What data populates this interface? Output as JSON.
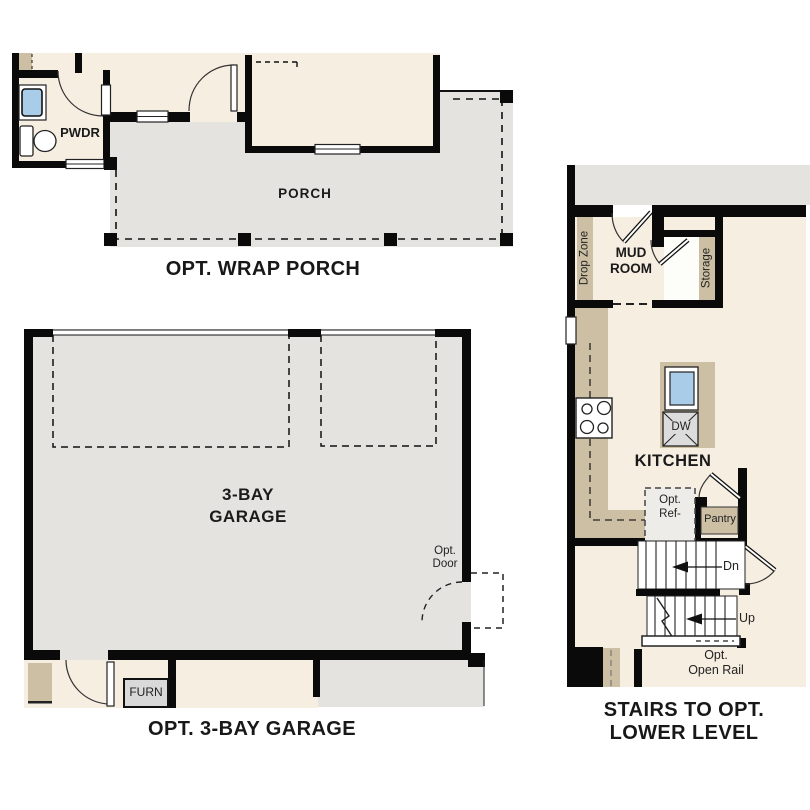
{
  "colors": {
    "wall": "#0a0a0a",
    "interior_floor": "#f6eee1",
    "concrete_floor": "#e4e3e0",
    "cabinet_tan": "#ccbfa3",
    "sink_blue": "#a9cde8",
    "appliance_gray": "#d9d9d9",
    "outline": "#222222"
  },
  "sections": {
    "wrap_porch": {
      "title": "OPT. WRAP PORCH",
      "porch": "PORCH",
      "powder_room": "PWDR"
    },
    "garage": {
      "title": "OPT. 3-BAY GARAGE",
      "name_line1": "3-BAY",
      "name_line2": "GARAGE",
      "opt_door_line1": "Opt.",
      "opt_door_line2": "Door",
      "furnace": "FURN"
    },
    "stairs": {
      "title_line1": "STAIRS TO OPT.",
      "title_line2": "LOWER LEVEL",
      "mud_room_line1": "MUD",
      "mud_room_line2": "ROOM",
      "drop_zone": "Drop Zone",
      "storage": "Storage",
      "kitchen": "KITCHEN",
      "dishwasher": "DW",
      "opt_ref_line1": "Opt.",
      "opt_ref_line2": "Ref-",
      "pantry": "Pantry",
      "stairs_down": "Dn",
      "stairs_up": "Up",
      "open_rail_line1": "Opt.",
      "open_rail_line2": "Open Rail"
    }
  }
}
